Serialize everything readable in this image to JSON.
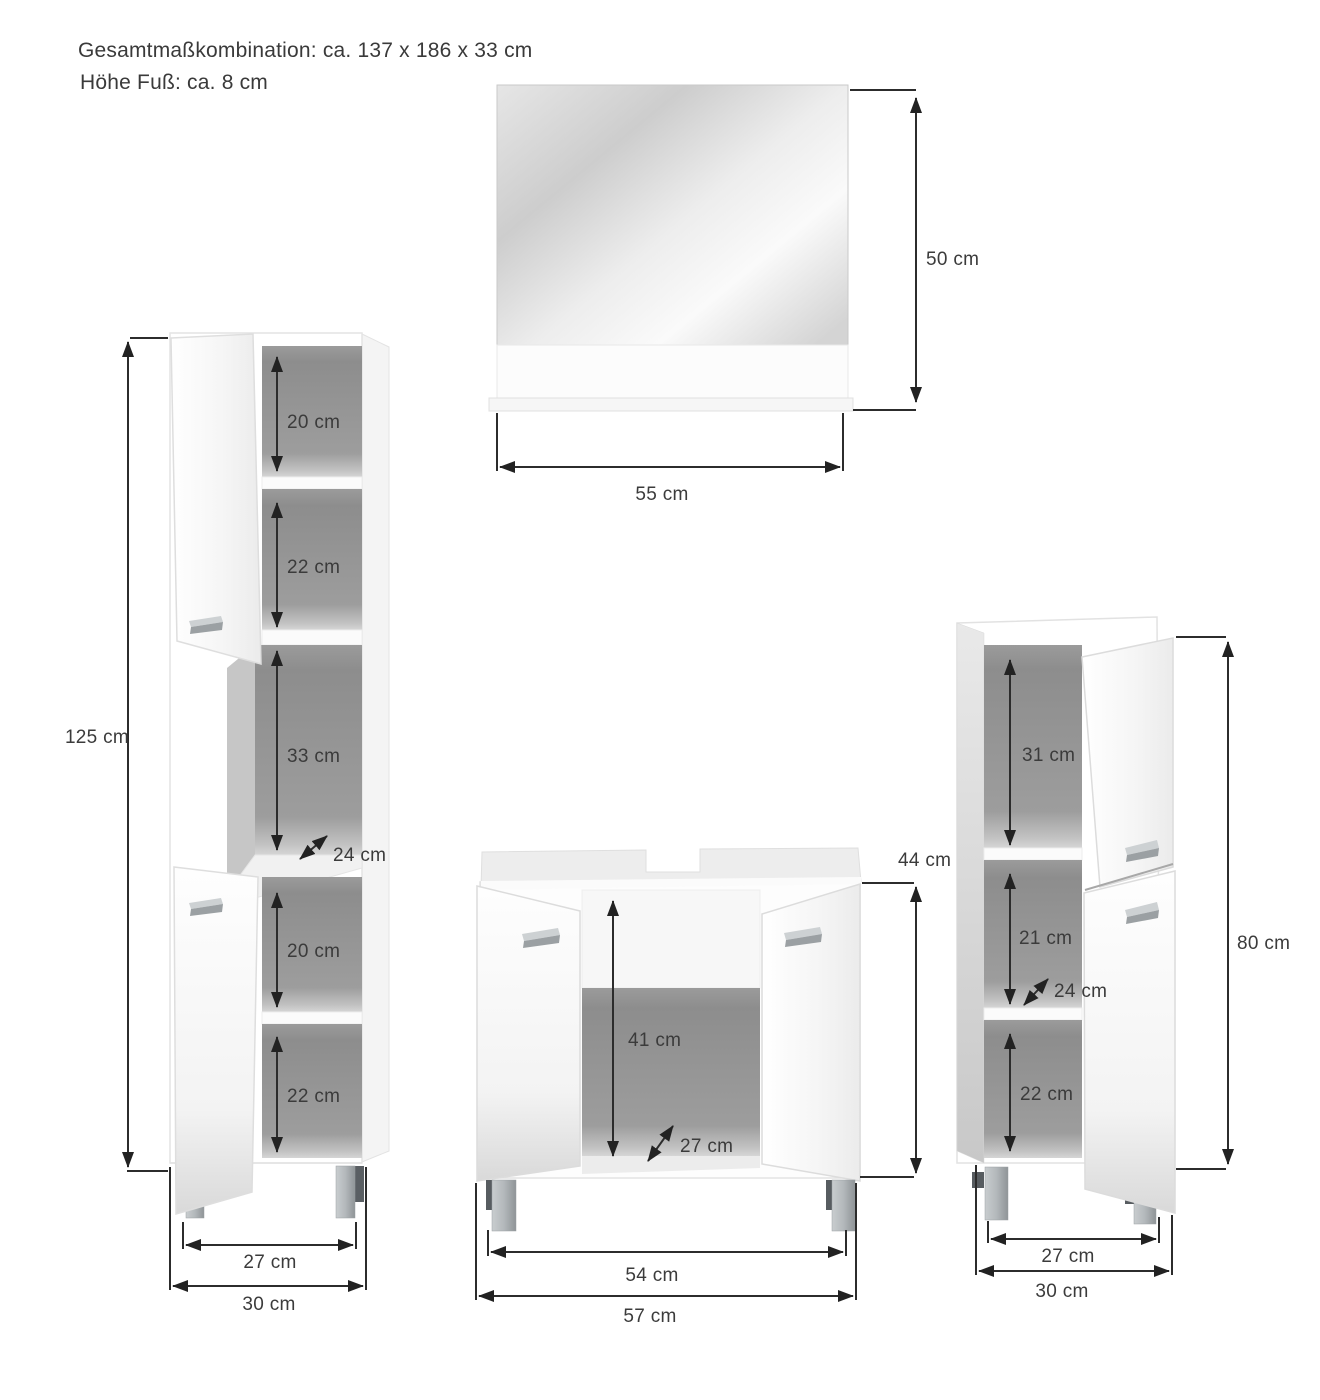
{
  "header": {
    "line1": "Gesamtmaßkombination: ca. 137 x 186 x 33 cm",
    "line2": "Höhe Fuß: ca. 8 cm"
  },
  "colors": {
    "background": "#ffffff",
    "text": "#3b3b3b",
    "dimension_line": "#2c2c2c",
    "interior_gray": "#929292",
    "leg_gray": "#a9aeb1"
  },
  "mirror": {
    "height": "50 cm",
    "width": "55 cm"
  },
  "tall_cabinet": {
    "height": "125 cm",
    "compartments": [
      "20 cm",
      "22 cm",
      "33 cm",
      "20 cm",
      "22 cm"
    ],
    "depth": "24 cm",
    "inner_width": "27 cm",
    "outer_width": "30 cm"
  },
  "vanity_cabinet": {
    "height": "44 cm",
    "inner_height": "41 cm",
    "depth": "27 cm",
    "inner_width": "54 cm",
    "outer_width": "57 cm"
  },
  "side_cabinet": {
    "height": "80 cm",
    "compartments": [
      "31 cm",
      "21 cm",
      "22 cm"
    ],
    "depth": "24 cm",
    "inner_width": "27 cm",
    "outer_width": "30 cm"
  }
}
